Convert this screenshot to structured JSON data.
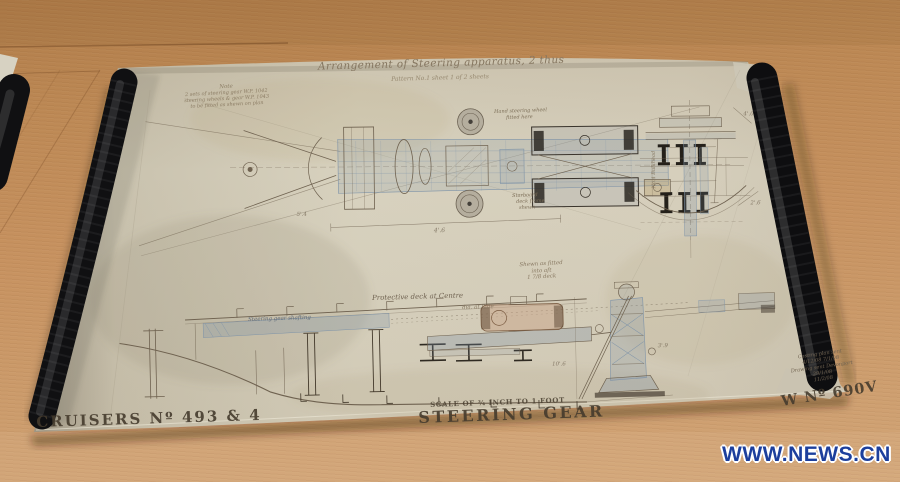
{
  "scene": {
    "watermark": "WWW.NEWS.CN"
  },
  "drawing": {
    "title": "Arrangement of Steering apparatus, 2 thus",
    "subtitle": "Pattern No.1 sheet 1 of 2 sheets",
    "note_block": {
      "heading": "Note",
      "line1": "2 sets of steering gear W.P. 1042",
      "line2": "steering wheels & gear W.P. 1043",
      "line3": "to be fitted as shewn on plan"
    },
    "plan": {
      "annotation_top1": "Hand steering wheel",
      "annotation_top2": "fitted here",
      "annotation_bottom1": "Starboard",
      "annotation_bottom2": "deck frame",
      "annotation_bottom3": "shewn",
      "dim_width": "4'.6",
      "dim_left": "5'.4"
    },
    "section": {
      "label": "No.4 Bulkhead",
      "dim_top": "4'.0",
      "dim_bottom": "2'.6"
    },
    "mid_note": {
      "line1": "Shewn as fitted",
      "line2": "into aft",
      "line3": "1 7/8 deck"
    },
    "profile": {
      "label": "Protective deck at Centre",
      "sublabel": "dia. at Side",
      "band_label": "Steering gear shafting",
      "dim_height": "10'.6",
      "dim_base": "3'.9"
    },
    "corner_notes": {
      "line1": "Casting plan sent",
      "line2": "4/12/08   7/1/08",
      "line3": "Drawing sent Devonport",
      "line4": "29/1/08",
      "line5": "11/2/08"
    },
    "footer": {
      "left": "CRUISERS Nº 493 & 4",
      "scale": "SCALE OF ¾ INCH TO 1 FOOT",
      "center": "STEERING GEAR",
      "right": "W Nº 690V"
    }
  }
}
